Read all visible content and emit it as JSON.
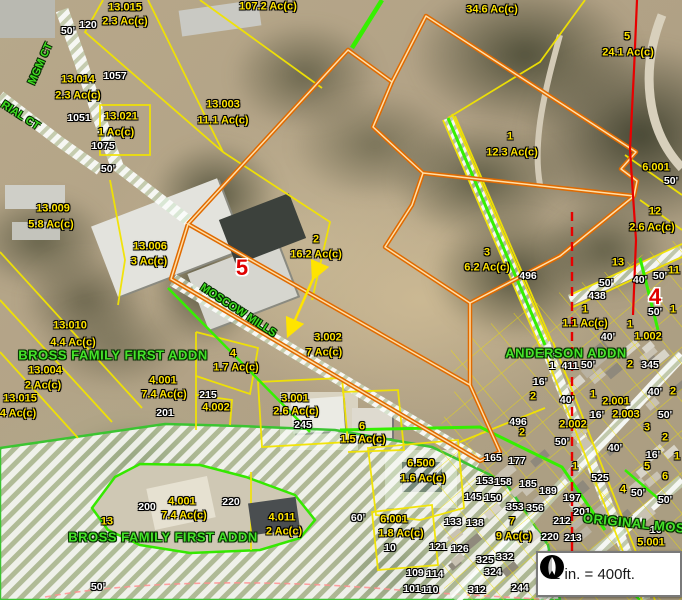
{
  "app": {
    "type": "county-parcel-map-viewer"
  },
  "scale_box": {
    "text": "1 in. = 400ft.",
    "icon": "north-arrow"
  },
  "map": {
    "colors": {
      "parcel_label": "#ffe400",
      "address_label": "#ffffff",
      "subdivision_label": "#46e32a",
      "street_label": "#3fdc20",
      "section_number": "#e00000",
      "parcel_line": "#f2e400",
      "highlight_parcel_line": "#e06a00",
      "boundary_green": "#35f000",
      "section_line": "#e80000"
    },
    "labels": [
      {
        "t": "13.015",
        "x": 125,
        "y": 8,
        "c": "y"
      },
      {
        "t": "2.3 Ac(c)",
        "x": 125,
        "y": 22,
        "c": "y"
      },
      {
        "t": "107.2 Ac(c)",
        "x": 268,
        "y": 7,
        "c": "y"
      },
      {
        "t": "34.6 Ac(c)",
        "x": 492,
        "y": 10,
        "c": "y"
      },
      {
        "t": "5",
        "x": 627,
        "y": 37,
        "c": "y"
      },
      {
        "t": "24.1 Ac(c)",
        "x": 628,
        "y": 53,
        "c": "y"
      },
      {
        "t": "13.014",
        "x": 78,
        "y": 80,
        "c": "y"
      },
      {
        "t": "2.3 Ac(c)",
        "x": 78,
        "y": 96,
        "c": "y"
      },
      {
        "t": "13.021",
        "x": 121,
        "y": 117,
        "c": "y"
      },
      {
        "t": "1 Ac(c)",
        "x": 116,
        "y": 133,
        "c": "y"
      },
      {
        "t": "13.003",
        "x": 223,
        "y": 105,
        "c": "y"
      },
      {
        "t": "11.1 Ac(c)",
        "x": 223,
        "y": 121,
        "c": "y"
      },
      {
        "t": "1",
        "x": 510,
        "y": 137,
        "c": "y"
      },
      {
        "t": "12.3 Ac(c)",
        "x": 512,
        "y": 153,
        "c": "y"
      },
      {
        "t": "13.009",
        "x": 53,
        "y": 209,
        "c": "y"
      },
      {
        "t": "5.8 Ac(c)",
        "x": 51,
        "y": 225,
        "c": "y"
      },
      {
        "t": "13.006",
        "x": 150,
        "y": 247,
        "c": "y"
      },
      {
        "t": "3 Ac(c)",
        "x": 149,
        "y": 262,
        "c": "y"
      },
      {
        "t": "6.001",
        "x": 656,
        "y": 168,
        "c": "y"
      },
      {
        "t": "50'",
        "x": 671,
        "y": 181,
        "c": "w"
      },
      {
        "t": "12",
        "x": 655,
        "y": 212,
        "c": "y"
      },
      {
        "t": "2.6 Ac(c)",
        "x": 652,
        "y": 228,
        "c": "y"
      },
      {
        "t": "2",
        "x": 316,
        "y": 240,
        "c": "y"
      },
      {
        "t": "16.2 Ac(c)",
        "x": 316,
        "y": 255,
        "c": "y"
      },
      {
        "t": "3",
        "x": 487,
        "y": 253,
        "c": "y"
      },
      {
        "t": "6.2 Ac(c)",
        "x": 487,
        "y": 268,
        "c": "y"
      },
      {
        "t": "13",
        "x": 618,
        "y": 263,
        "c": "y"
      },
      {
        "t": "11",
        "x": 674,
        "y": 271,
        "c": "y"
      },
      {
        "t": "496",
        "x": 528,
        "y": 276,
        "c": "w"
      },
      {
        "t": "50'",
        "x": 606,
        "y": 283,
        "c": "w"
      },
      {
        "t": "438",
        "x": 597,
        "y": 296,
        "c": "w"
      },
      {
        "t": "40'",
        "x": 640,
        "y": 280,
        "c": "w"
      },
      {
        "t": "50'",
        "x": 660,
        "y": 276,
        "c": "w"
      },
      {
        "t": "5",
        "x": 242,
        "y": 268,
        "c": "r"
      },
      {
        "t": "4",
        "x": 655,
        "y": 297,
        "c": "r"
      },
      {
        "t": "1",
        "x": 585,
        "y": 310,
        "c": "y"
      },
      {
        "t": "1.1 Ac(c)",
        "x": 585,
        "y": 324,
        "c": "y"
      },
      {
        "t": "1",
        "x": 673,
        "y": 310,
        "c": "y"
      },
      {
        "t": "50'",
        "x": 655,
        "y": 312,
        "c": "w"
      },
      {
        "t": "13.010",
        "x": 70,
        "y": 326,
        "c": "y"
      },
      {
        "t": "4.4 Ac(c)",
        "x": 73,
        "y": 343,
        "c": "y"
      },
      {
        "t": "13.004",
        "x": 45,
        "y": 371,
        "c": "y"
      },
      {
        "t": "2 Ac(c)",
        "x": 43,
        "y": 386,
        "c": "y"
      },
      {
        "t": "13.015",
        "x": 20,
        "y": 399,
        "c": "y"
      },
      {
        "t": "4 Ac(c)",
        "x": 18,
        "y": 414,
        "c": "y"
      },
      {
        "t": "4",
        "x": 233,
        "y": 354,
        "c": "y"
      },
      {
        "t": "1.7 Ac(c)",
        "x": 236,
        "y": 368,
        "c": "y"
      },
      {
        "t": "4.001",
        "x": 163,
        "y": 381,
        "c": "y"
      },
      {
        "t": "7.4 Ac(c)",
        "x": 164,
        "y": 395,
        "c": "y"
      },
      {
        "t": "215",
        "x": 208,
        "y": 395,
        "c": "w"
      },
      {
        "t": "4.002",
        "x": 216,
        "y": 408,
        "c": "y"
      },
      {
        "t": "201",
        "x": 165,
        "y": 413,
        "c": "w"
      },
      {
        "t": "3.001",
        "x": 295,
        "y": 399,
        "c": "y"
      },
      {
        "t": "2.6 Ac(c)",
        "x": 296,
        "y": 412,
        "c": "y"
      },
      {
        "t": "245",
        "x": 303,
        "y": 425,
        "c": "w"
      },
      {
        "t": "6",
        "x": 362,
        "y": 427,
        "c": "y"
      },
      {
        "t": "1.5 Ac(c)",
        "x": 363,
        "y": 440,
        "c": "y"
      },
      {
        "t": "3.002",
        "x": 328,
        "y": 338,
        "c": "y"
      },
      {
        "t": "7 Ac(c)",
        "x": 324,
        "y": 353,
        "c": "y"
      },
      {
        "t": "1",
        "x": 552,
        "y": 366,
        "c": "w"
      },
      {
        "t": "411",
        "x": 570,
        "y": 366,
        "c": "w"
      },
      {
        "t": "50'",
        "x": 588,
        "y": 365,
        "c": "w"
      },
      {
        "t": "2",
        "x": 630,
        "y": 365,
        "c": "y"
      },
      {
        "t": "345",
        "x": 650,
        "y": 365,
        "c": "w"
      },
      {
        "t": "40'",
        "x": 608,
        "y": 337,
        "c": "w"
      },
      {
        "t": "1",
        "x": 630,
        "y": 325,
        "c": "y"
      },
      {
        "t": "1.002",
        "x": 648,
        "y": 337,
        "c": "y"
      },
      {
        "t": "16'",
        "x": 540,
        "y": 382,
        "c": "w"
      },
      {
        "t": "2",
        "x": 533,
        "y": 397,
        "c": "y"
      },
      {
        "t": "40'",
        "x": 567,
        "y": 400,
        "c": "w"
      },
      {
        "t": "1",
        "x": 593,
        "y": 395,
        "c": "y"
      },
      {
        "t": "2.001",
        "x": 616,
        "y": 402,
        "c": "y"
      },
      {
        "t": "16'",
        "x": 597,
        "y": 415,
        "c": "w"
      },
      {
        "t": "2.003",
        "x": 626,
        "y": 415,
        "c": "y"
      },
      {
        "t": "50'",
        "x": 665,
        "y": 415,
        "c": "w"
      },
      {
        "t": "40'",
        "x": 655,
        "y": 392,
        "c": "w"
      },
      {
        "t": "2",
        "x": 673,
        "y": 392,
        "c": "y"
      },
      {
        "t": "2.002",
        "x": 573,
        "y": 425,
        "c": "y"
      },
      {
        "t": "3",
        "x": 647,
        "y": 428,
        "c": "y"
      },
      {
        "t": "2",
        "x": 665,
        "y": 438,
        "c": "y"
      },
      {
        "t": "50'",
        "x": 562,
        "y": 442,
        "c": "w"
      },
      {
        "t": "40'",
        "x": 615,
        "y": 448,
        "c": "w"
      },
      {
        "t": "16'",
        "x": 653,
        "y": 455,
        "c": "w"
      },
      {
        "t": "4",
        "x": 623,
        "y": 490,
        "c": "y"
      },
      {
        "t": "5",
        "x": 647,
        "y": 467,
        "c": "y"
      },
      {
        "t": "6",
        "x": 665,
        "y": 477,
        "c": "y"
      },
      {
        "t": "1",
        "x": 677,
        "y": 457,
        "c": "y"
      },
      {
        "t": "1",
        "x": 575,
        "y": 467,
        "c": "y"
      },
      {
        "t": "525",
        "x": 600,
        "y": 478,
        "c": "w"
      },
      {
        "t": "6.500",
        "x": 421,
        "y": 464,
        "c": "y"
      },
      {
        "t": "1.6 Ac(c)",
        "x": 423,
        "y": 479,
        "c": "y"
      },
      {
        "t": "496",
        "x": 518,
        "y": 422,
        "c": "w"
      },
      {
        "t": "2",
        "x": 522,
        "y": 433,
        "c": "y"
      },
      {
        "t": "165",
        "x": 493,
        "y": 458,
        "c": "w"
      },
      {
        "t": "177",
        "x": 517,
        "y": 461,
        "c": "w"
      },
      {
        "t": "153",
        "x": 485,
        "y": 481,
        "c": "w"
      },
      {
        "t": "158",
        "x": 503,
        "y": 482,
        "c": "w"
      },
      {
        "t": "185",
        "x": 528,
        "y": 484,
        "c": "w"
      },
      {
        "t": "189",
        "x": 548,
        "y": 491,
        "c": "w"
      },
      {
        "t": "145",
        "x": 473,
        "y": 497,
        "c": "w"
      },
      {
        "t": "150",
        "x": 493,
        "y": 498,
        "c": "w"
      },
      {
        "t": "353",
        "x": 515,
        "y": 507,
        "c": "w"
      },
      {
        "t": "356",
        "x": 535,
        "y": 508,
        "c": "w"
      },
      {
        "t": "133",
        "x": 453,
        "y": 522,
        "c": "w"
      },
      {
        "t": "138",
        "x": 475,
        "y": 523,
        "c": "w"
      },
      {
        "t": "7",
        "x": 512,
        "y": 522,
        "c": "y"
      },
      {
        "t": "9 Ac(c)",
        "x": 514,
        "y": 537,
        "c": "y"
      },
      {
        "t": "220",
        "x": 550,
        "y": 537,
        "c": "w"
      },
      {
        "t": "121",
        "x": 438,
        "y": 547,
        "c": "w"
      },
      {
        "t": "126",
        "x": 460,
        "y": 549,
        "c": "w"
      },
      {
        "t": "109",
        "x": 415,
        "y": 573,
        "c": "w"
      },
      {
        "t": "114",
        "x": 435,
        "y": 574,
        "c": "w"
      },
      {
        "t": "101",
        "x": 412,
        "y": 589,
        "c": "w"
      },
      {
        "t": "110",
        "x": 430,
        "y": 590,
        "c": "w"
      },
      {
        "t": "325",
        "x": 485,
        "y": 560,
        "c": "w"
      },
      {
        "t": "332",
        "x": 505,
        "y": 557,
        "c": "w"
      },
      {
        "t": "324",
        "x": 493,
        "y": 572,
        "c": "w"
      },
      {
        "t": "312",
        "x": 477,
        "y": 590,
        "c": "w"
      },
      {
        "t": "244",
        "x": 520,
        "y": 588,
        "c": "w"
      },
      {
        "t": "197",
        "x": 572,
        "y": 498,
        "c": "w"
      },
      {
        "t": "201",
        "x": 582,
        "y": 512,
        "c": "w"
      },
      {
        "t": "212",
        "x": 562,
        "y": 521,
        "c": "w"
      },
      {
        "t": "213",
        "x": 573,
        "y": 538,
        "c": "w"
      },
      {
        "t": "50'",
        "x": 638,
        "y": 493,
        "c": "w"
      },
      {
        "t": "50'",
        "x": 665,
        "y": 500,
        "c": "w"
      },
      {
        "t": "16'",
        "x": 657,
        "y": 530,
        "c": "w"
      },
      {
        "t": "5.001",
        "x": 651,
        "y": 543,
        "c": "y"
      },
      {
        "t": "6.001",
        "x": 394,
        "y": 520,
        "c": "y"
      },
      {
        "t": "1.8 Ac(c)",
        "x": 401,
        "y": 534,
        "c": "y"
      },
      {
        "t": "10",
        "x": 390,
        "y": 548,
        "c": "w"
      },
      {
        "t": "60'",
        "x": 358,
        "y": 518,
        "c": "w"
      },
      {
        "t": "4.011",
        "x": 282,
        "y": 518,
        "c": "y"
      },
      {
        "t": "2 Ac(c)",
        "x": 284,
        "y": 532,
        "c": "y"
      },
      {
        "t": "4.001",
        "x": 182,
        "y": 502,
        "c": "y"
      },
      {
        "t": "7.4 Ac(c)",
        "x": 184,
        "y": 516,
        "c": "y"
      },
      {
        "t": "200",
        "x": 147,
        "y": 507,
        "c": "w"
      },
      {
        "t": "220",
        "x": 231,
        "y": 502,
        "c": "w"
      },
      {
        "t": "13",
        "x": 107,
        "y": 522,
        "c": "y"
      },
      {
        "t": "50'",
        "x": 98,
        "y": 587,
        "c": "w"
      },
      {
        "t": "120",
        "x": 88,
        "y": 25,
        "c": "w"
      },
      {
        "t": "50'",
        "x": 68,
        "y": 31,
        "c": "w"
      },
      {
        "t": "1057",
        "x": 115,
        "y": 76,
        "c": "w"
      },
      {
        "t": "1051",
        "x": 79,
        "y": 118,
        "c": "w"
      },
      {
        "t": "1075",
        "x": 103,
        "y": 146,
        "c": "w"
      },
      {
        "t": "50'",
        "x": 108,
        "y": 169,
        "c": "w"
      },
      {
        "t": "BROSS FAMILY FIRST ADDN",
        "x": 113,
        "y": 355,
        "c": "g"
      },
      {
        "t": "ANDERSON ADDN",
        "x": 566,
        "y": 353,
        "c": "g"
      },
      {
        "t": "BROSS FAMILY FIRST ADDN",
        "x": 163,
        "y": 537,
        "c": "g"
      },
      {
        "t": "ORIGINAL MOS",
        "x": 634,
        "y": 523,
        "c": "g",
        "r": 6
      },
      {
        "t": "MGM CT",
        "x": 41,
        "y": 64,
        "c": "s",
        "r": -66
      },
      {
        "t": "RIAL CT",
        "x": 20,
        "y": 116,
        "c": "s",
        "r": 33
      },
      {
        "t": "MOSCOW MILLS",
        "x": 238,
        "y": 311,
        "c": "s",
        "r": 33
      }
    ]
  }
}
